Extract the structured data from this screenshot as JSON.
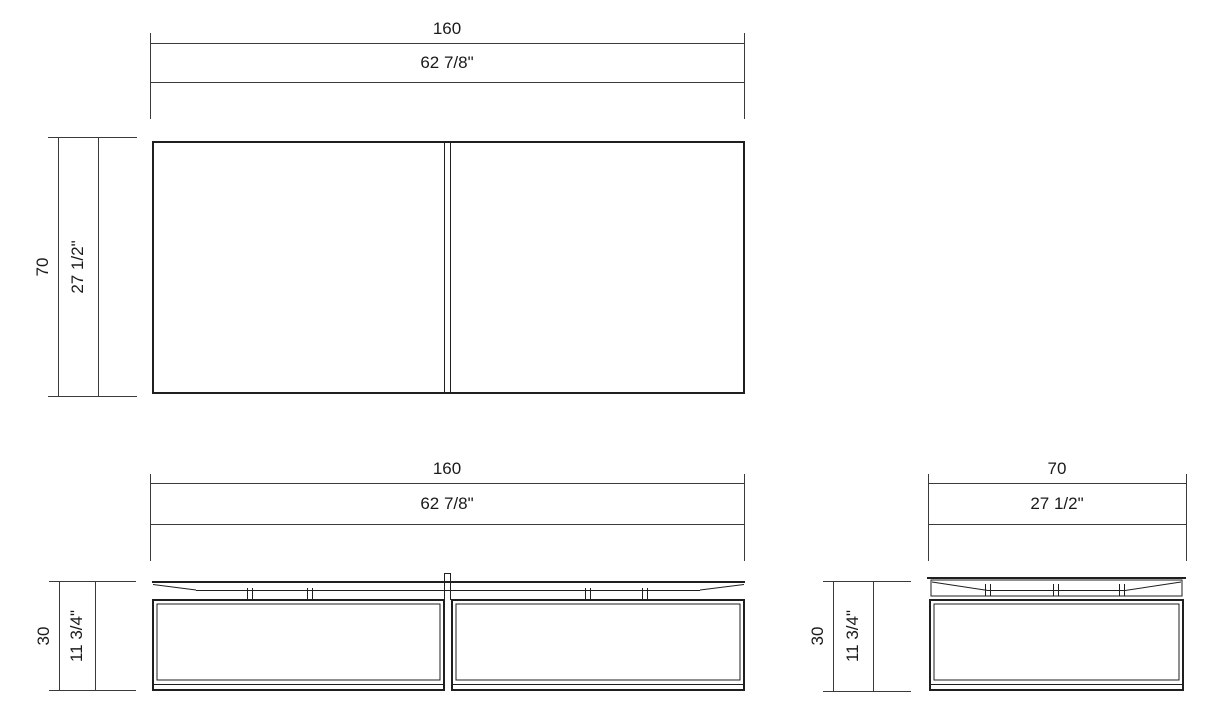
{
  "drawing": {
    "type": "furniture-dimension-drawing",
    "views": {
      "plan": {
        "width_cm": "160",
        "width_in": "62 7/8\"",
        "depth_cm": "70",
        "depth_in": "27 1/2\""
      },
      "front": {
        "width_cm": "160",
        "width_in": "62 7/8\"",
        "height_cm": "30",
        "height_in": "11 3/4\""
      },
      "side": {
        "width_cm": "70",
        "width_in": "27 1/2\"",
        "height_cm": "30",
        "height_in": "11 3/4\""
      }
    }
  },
  "colors": {
    "background": "#ffffff",
    "line": "#1f1f1f",
    "dimension_line": "#3a3a3a",
    "text": "#1a1a1a"
  }
}
